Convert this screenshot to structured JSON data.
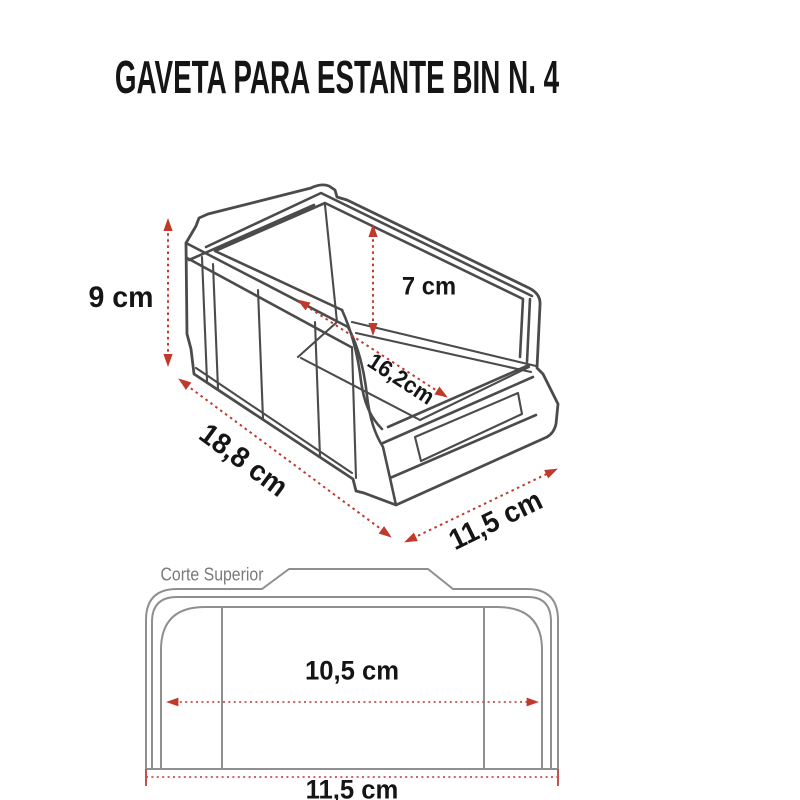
{
  "title": "GAVETA PARA ESTANTE BIN N. 4",
  "colors": {
    "dimension_red": "#c0392b",
    "drawing_dark_gray": "#4b4b4b",
    "drawing_light_gray": "#8f8f8f",
    "caption_gray": "#7a7a7a",
    "text_black": "#151515",
    "background": "#ffffff"
  },
  "isometric_view": {
    "labels": {
      "height": "9 cm",
      "inner_height": "7 cm",
      "inner_length": "16,2cm",
      "length": "18,8 cm",
      "width": "11,5 cm"
    }
  },
  "top_view": {
    "caption": "Corte Superior",
    "labels": {
      "inner_width": "10,5 cm",
      "outer_width": "11,5 cm"
    }
  }
}
